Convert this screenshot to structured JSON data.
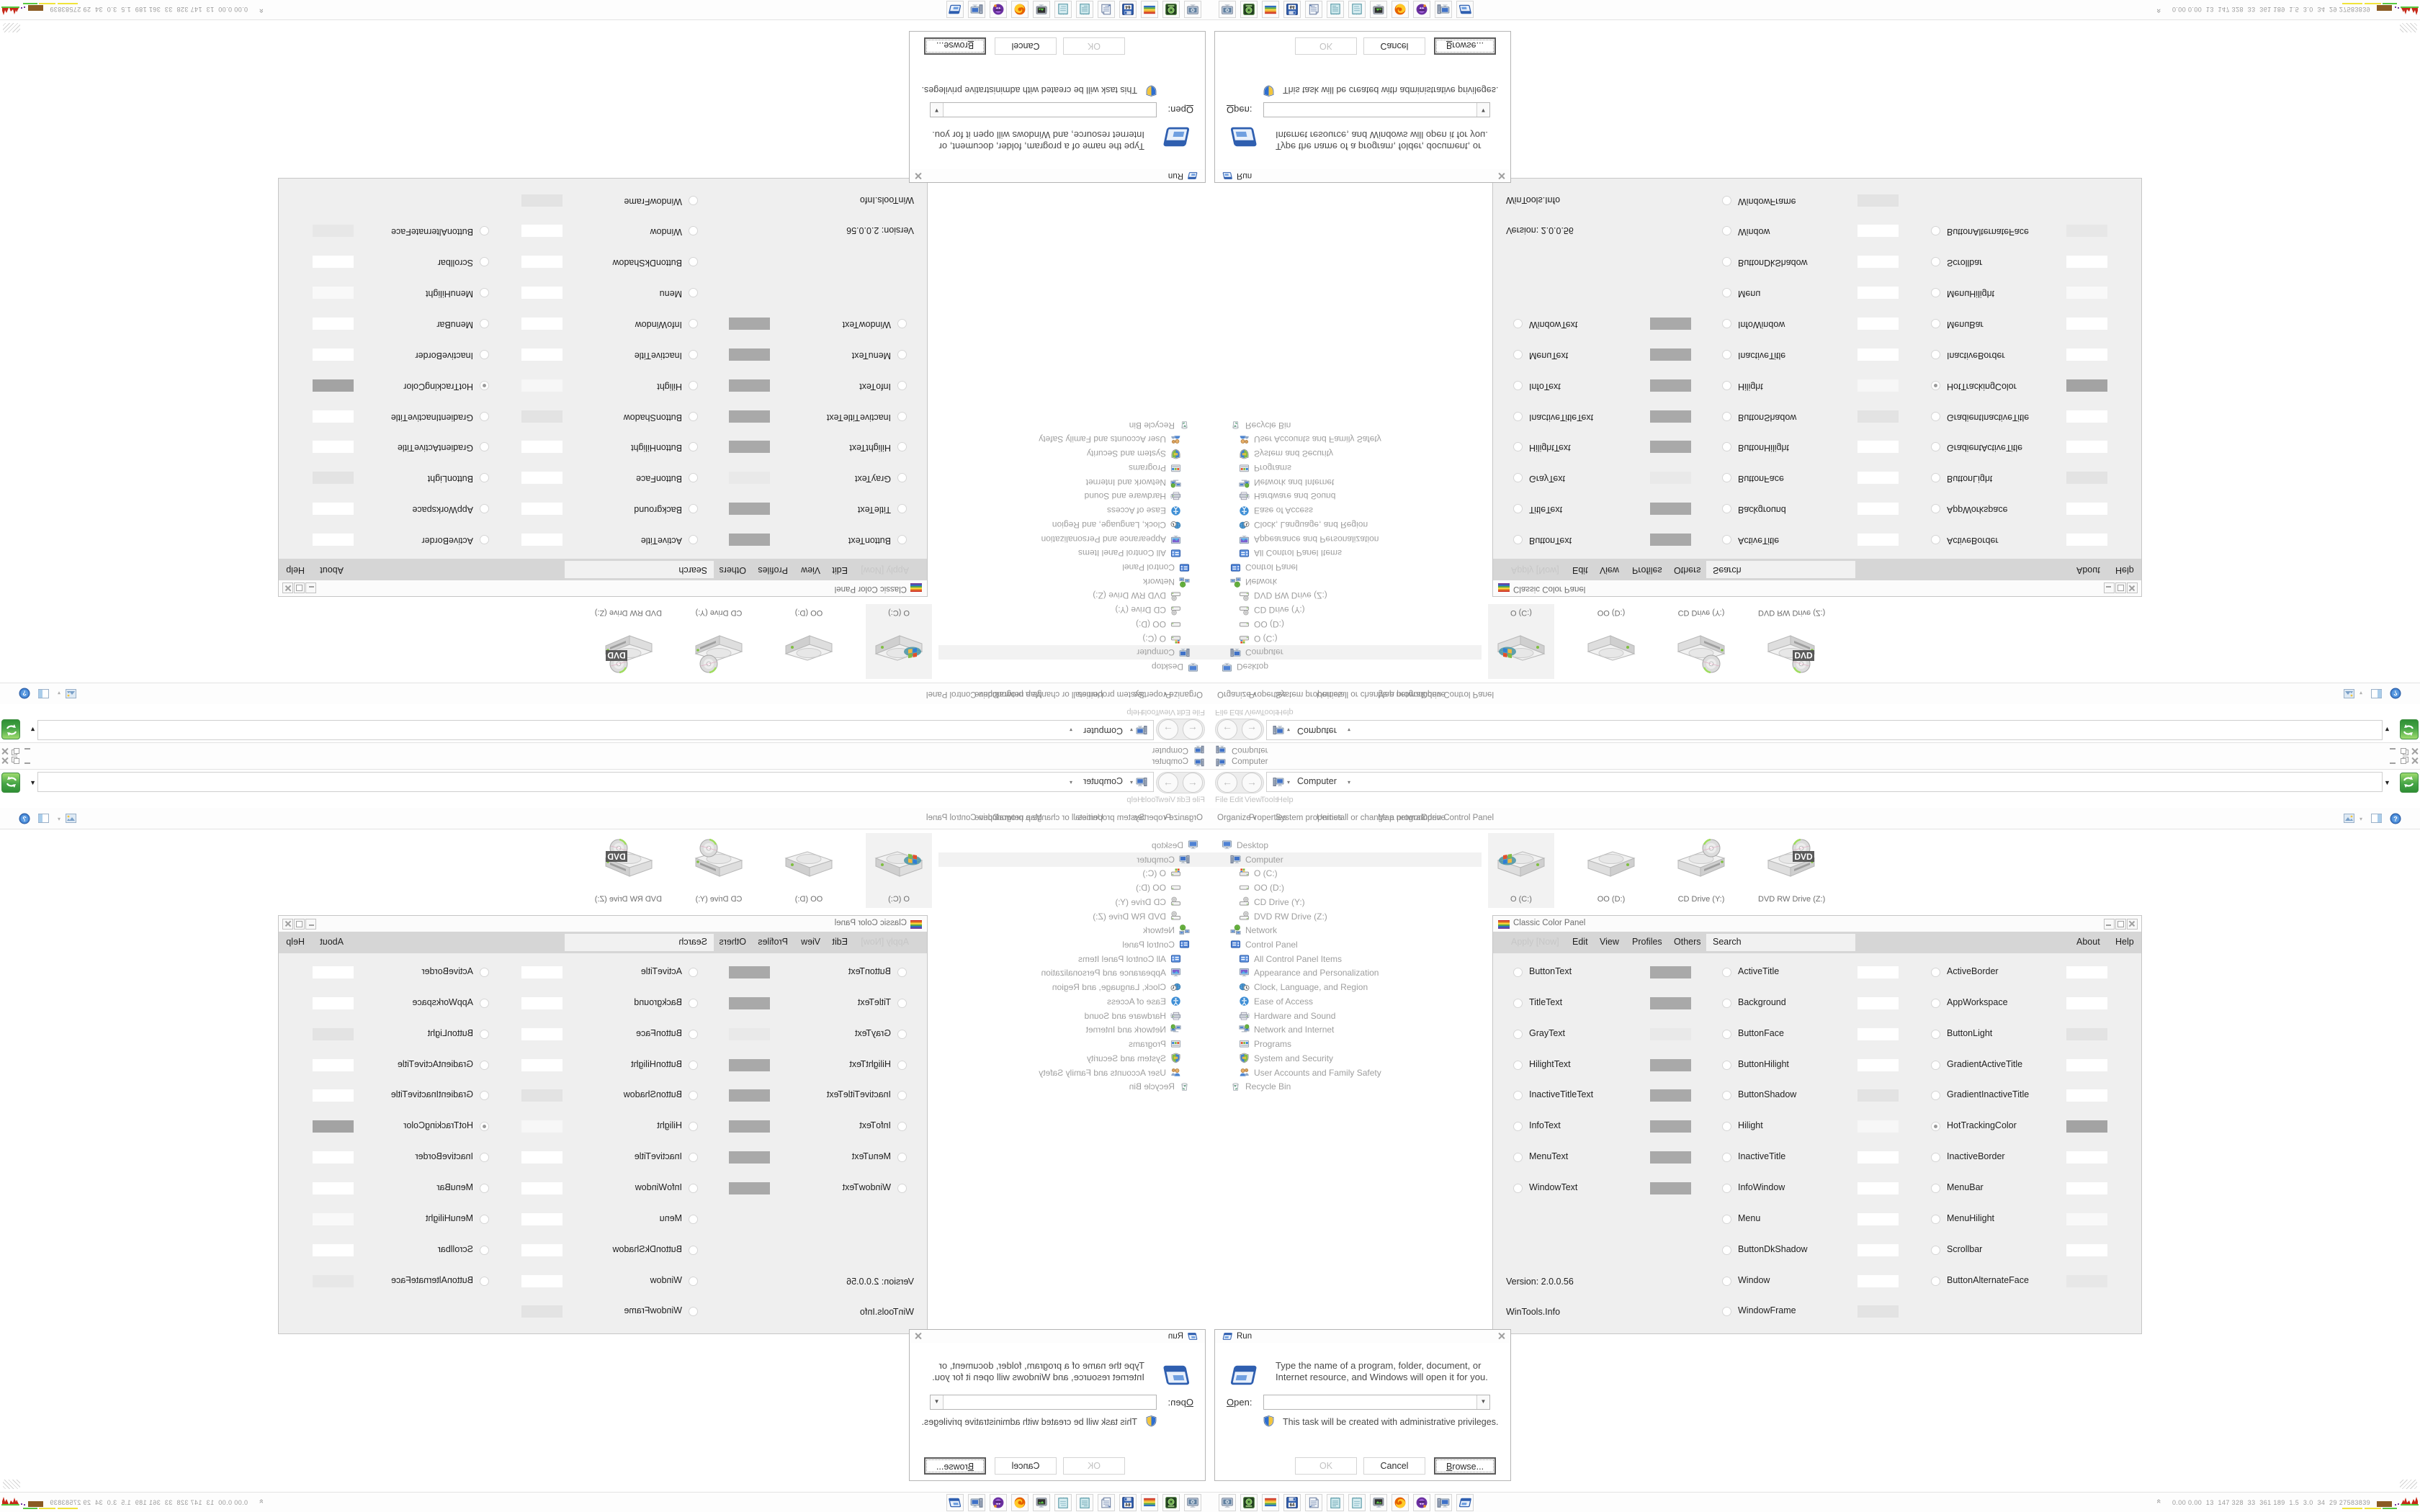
{
  "desktop": {
    "background": "#ffffff"
  },
  "explorer": {
    "title": "Computer",
    "address": {
      "breadcrumb": "Computer"
    },
    "menu": [
      "File",
      "Edit",
      "View",
      "Tools",
      "Help"
    ],
    "toolbar": {
      "organize": "Organize",
      "commands": [
        "Properties",
        "System properties",
        "Uninstall or change a program",
        "Map network drive",
        "Open Control Panel"
      ]
    },
    "tree": [
      {
        "label": "Desktop",
        "icon": "desktop-icon",
        "level": 0,
        "selected": false
      },
      {
        "label": "Computer",
        "icon": "computer-icon",
        "level": 1,
        "selected": true
      },
      {
        "label": "O (C:)",
        "icon": "system-drive-icon",
        "level": 2,
        "selected": false
      },
      {
        "label": "OO (D:)",
        "icon": "drive-icon",
        "level": 2,
        "selected": false
      },
      {
        "label": "CD Drive (Y:)",
        "icon": "cd-drive-icon",
        "level": 2,
        "selected": false
      },
      {
        "label": "DVD RW Drive (Z:)",
        "icon": "cd-drive-icon",
        "level": 2,
        "selected": false
      },
      {
        "label": "Network",
        "icon": "network-icon",
        "level": 1,
        "selected": false
      },
      {
        "label": "Control Panel",
        "icon": "control-panel-icon",
        "level": 1,
        "selected": false
      },
      {
        "label": "All Control Panel Items",
        "icon": "control-panel-items-icon",
        "level": 2,
        "selected": false
      },
      {
        "label": "Appearance and Personalization",
        "icon": "appearance-icon",
        "level": 2,
        "selected": false
      },
      {
        "label": "Clock, Language, and Region",
        "icon": "clock-region-icon",
        "level": 2,
        "selected": false
      },
      {
        "label": "Ease of Access",
        "icon": "ease-of-access-icon",
        "level": 2,
        "selected": false
      },
      {
        "label": "Hardware and Sound",
        "icon": "hardware-sound-icon",
        "level": 2,
        "selected": false
      },
      {
        "label": "Network and Internet",
        "icon": "network-internet-icon",
        "level": 2,
        "selected": false
      },
      {
        "label": "Programs",
        "icon": "programs-icon",
        "level": 2,
        "selected": false
      },
      {
        "label": "System and Security",
        "icon": "system-security-icon",
        "level": 2,
        "selected": false
      },
      {
        "label": "User Accounts and Family Safety",
        "icon": "user-accounts-icon",
        "level": 2,
        "selected": false
      },
      {
        "label": "Recycle Bin",
        "icon": "recycle-bin-icon",
        "level": 1,
        "selected": false
      }
    ],
    "files": [
      {
        "label": "O (C:)",
        "icon": "system-drive-large-icon",
        "selected": true
      },
      {
        "label": "OO (D:)",
        "icon": "drive-large-icon",
        "selected": false
      },
      {
        "label": "CD Drive (Y:)",
        "icon": "cd-drive-large-icon",
        "selected": false
      },
      {
        "label": "DVD RW Drive (Z:)",
        "icon": "dvd-drive-large-icon",
        "selected": false
      }
    ]
  },
  "color_panel": {
    "title": "Classic Color Panel",
    "menu_disabled": "Apply [Now]",
    "menu": [
      "Edit",
      "View",
      "Profiles",
      "Others"
    ],
    "search_value": "Search",
    "menu_right": [
      "About",
      "Help"
    ],
    "version": "Version: 2.0.0.56",
    "vendor": "WinTools.Info",
    "column1": [
      {
        "label": "ButtonText",
        "swatch": "#a9a9a9",
        "selected": false
      },
      {
        "label": "TitleText",
        "swatch": "#a9a9a9",
        "selected": false
      },
      {
        "label": "GrayText",
        "swatch": "#e9e9e9",
        "selected": false
      },
      {
        "label": "HilightText",
        "swatch": "#a9a9a9",
        "selected": false
      },
      {
        "label": "InactiveTitleText",
        "swatch": "#a9a9a9",
        "selected": false
      },
      {
        "label": "InfoText",
        "swatch": "#a9a9a9",
        "selected": false
      },
      {
        "label": "MenuText",
        "swatch": "#a9a9a9",
        "selected": false
      },
      {
        "label": "WindowText",
        "swatch": "#a9a9a9",
        "selected": false
      }
    ],
    "column2": [
      {
        "label": "ActiveTitle",
        "swatch": "#ffffff",
        "selected": false
      },
      {
        "label": "Background",
        "swatch": "#ffffff",
        "selected": false
      },
      {
        "label": "ButtonFace",
        "swatch": "#ffffff",
        "selected": false
      },
      {
        "label": "ButtonHilight",
        "swatch": "#ffffff",
        "selected": false
      },
      {
        "label": "ButtonShadow",
        "swatch": "#e3e3e3",
        "selected": false
      },
      {
        "label": "Hilight",
        "swatch": "#f7f7f7",
        "selected": false
      },
      {
        "label": "InactiveTitle",
        "swatch": "#ffffff",
        "selected": false
      },
      {
        "label": "InfoWindow",
        "swatch": "#ffffff",
        "selected": false
      },
      {
        "label": "Menu",
        "swatch": "#ffffff",
        "selected": false
      },
      {
        "label": "ButtonDkShadow",
        "swatch": "#ffffff",
        "selected": false
      },
      {
        "label": "Window",
        "swatch": "#ffffff",
        "selected": false
      },
      {
        "label": "WindowFrame",
        "swatch": "#e3e3e3",
        "selected": false
      }
    ],
    "column3": [
      {
        "label": "ActiveBorder",
        "swatch": "#ffffff",
        "selected": false
      },
      {
        "label": "AppWorkspace",
        "swatch": "#ffffff",
        "selected": false
      },
      {
        "label": "ButtonLight",
        "swatch": "#e3e3e3",
        "selected": false
      },
      {
        "label": "GradientActiveTitle",
        "swatch": "#ffffff",
        "selected": false
      },
      {
        "label": "GradientInactiveTitle",
        "swatch": "#ffffff",
        "selected": false
      },
      {
        "label": "HotTrackingColor",
        "swatch": "#a3a3a3",
        "selected": true
      },
      {
        "label": "InactiveBorder",
        "swatch": "#ffffff",
        "selected": false
      },
      {
        "label": "MenuBar",
        "swatch": "#ffffff",
        "selected": false
      },
      {
        "label": "MenuHilight",
        "swatch": "#f9f9f9",
        "selected": false
      },
      {
        "label": "Scrollbar",
        "swatch": "#ffffff",
        "selected": false
      },
      {
        "label": "ButtonAlternateFace",
        "swatch": "#e7e7e7",
        "selected": false
      }
    ]
  },
  "run_dialog": {
    "title": "Run",
    "message": "Type the name of a program, folder, document, or Internet resource, and Windows will open it for you.",
    "open_label": "Open:",
    "open_value": "",
    "admin_note": "This task will be created with administrative privileges.",
    "buttons": [
      {
        "label": "OK",
        "disabled": true,
        "focused": false
      },
      {
        "label": "Cancel",
        "disabled": false,
        "focused": false
      },
      {
        "label": "Browse...",
        "disabled": false,
        "focused": true
      }
    ]
  },
  "taskbar": {
    "apps": [
      {
        "icon": "display-settings-icon"
      },
      {
        "icon": "disc-burner-icon"
      },
      {
        "icon": "color-panel-icon"
      },
      {
        "icon": "floppy-64-icon"
      },
      {
        "icon": "document-viewer-icon"
      },
      {
        "icon": "notepad-icon"
      },
      {
        "icon": "notepad2-icon"
      },
      {
        "icon": "screen-saver-icon"
      },
      {
        "icon": "firefox-icon"
      },
      {
        "icon": "purple-app-icon"
      },
      {
        "icon": "my-computer-icon"
      },
      {
        "icon": "run-icon"
      }
    ],
    "tray_text": "0.00 0.00  13  147 328  33  361 189  1.5  3.0  34  29 27583839"
  },
  "accent": {
    "go_button_green": "#46a546",
    "selection_gray": "#f2f2f2"
  }
}
